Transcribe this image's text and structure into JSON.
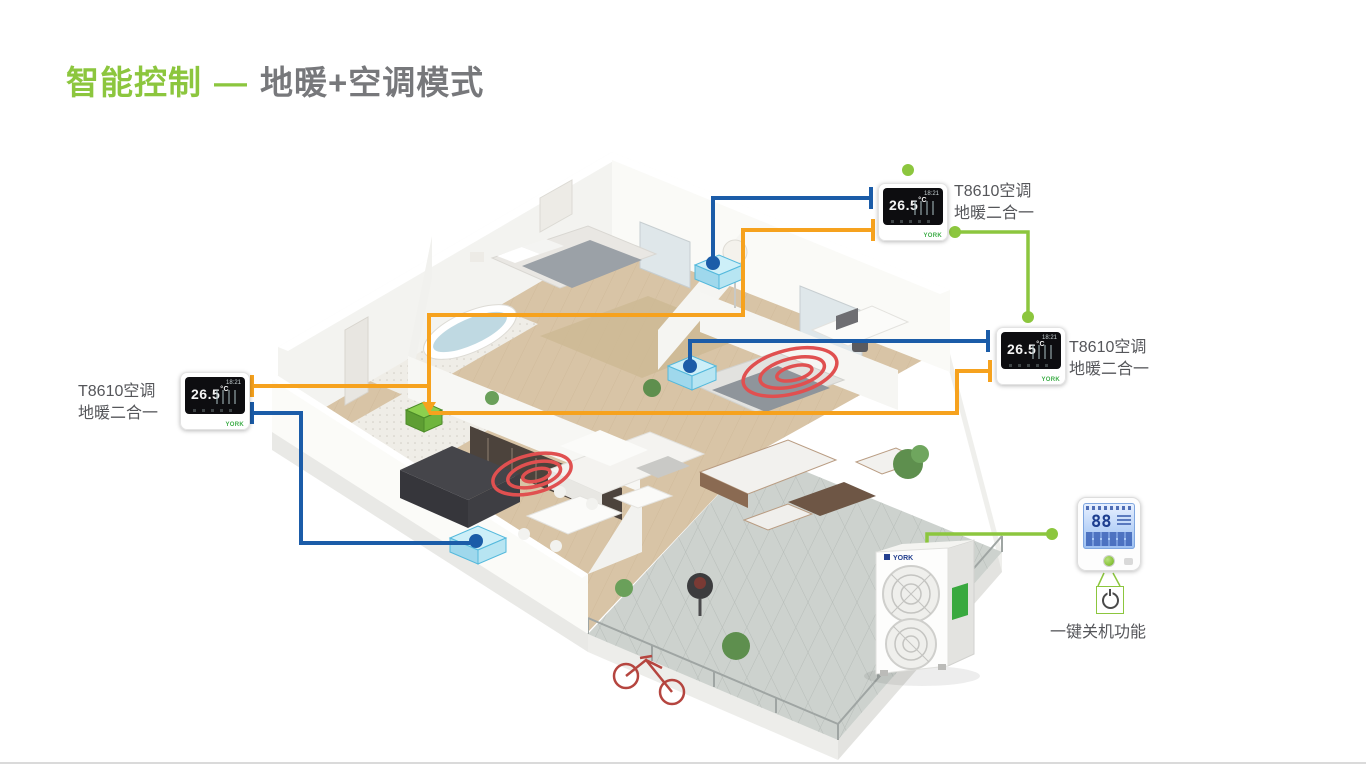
{
  "slide": {
    "title": {
      "green": "智能控制",
      "dash": "—",
      "gray": "地暖+空调模式"
    }
  },
  "labels": {
    "thermostat_left": {
      "line1": "T8610空调",
      "line2": "地暖二合一"
    },
    "thermostat_top": {
      "line1": "T8610空调",
      "line2": "地暖二合一"
    },
    "thermostat_right": {
      "line1": "T8610空调",
      "line2": "地暖二合一"
    },
    "controller": "一键关机功能"
  },
  "devices": {
    "thermostat": {
      "temp": "26.5",
      "unit": "°C",
      "time": "18:21",
      "brand": "YORK"
    },
    "wall_controller": {
      "display": "88"
    },
    "outdoor_unit": {
      "brand": "YORK"
    }
  },
  "icons": {
    "power_button": "power-symbol",
    "connection_dot": "filled-circle",
    "arrowhead": "triangle-down"
  },
  "colors": {
    "accent_green": "#8CC63E",
    "title_gray": "#77787B",
    "line_blue": "#1B5CA8",
    "line_orange": "#F6A21E",
    "coil_red": "#E05050",
    "fancoil_cyan": "#9FD8EC",
    "lcd_blue": "#BBD4F8",
    "screen_black": "#0D0D10"
  }
}
